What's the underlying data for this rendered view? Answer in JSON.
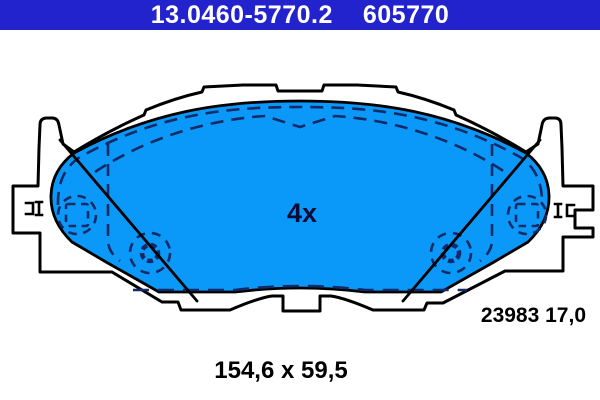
{
  "header": {
    "part_number": "13.0460-5770.2",
    "ate_number": "605770",
    "bar_color": "#2323CD",
    "text_color": "#FFFFFF"
  },
  "drawing": {
    "quantity_label": "4x",
    "wva_number_thickness": "23983 17,0",
    "dimensions": "154,6 x 59,5",
    "pad_fill_color": "#0B99F9",
    "plate_fill_color": "#FFFFFF",
    "outline_color": "#000000",
    "detail_line_color": "#132A66",
    "quantity_text_color": "#0B0B38"
  }
}
